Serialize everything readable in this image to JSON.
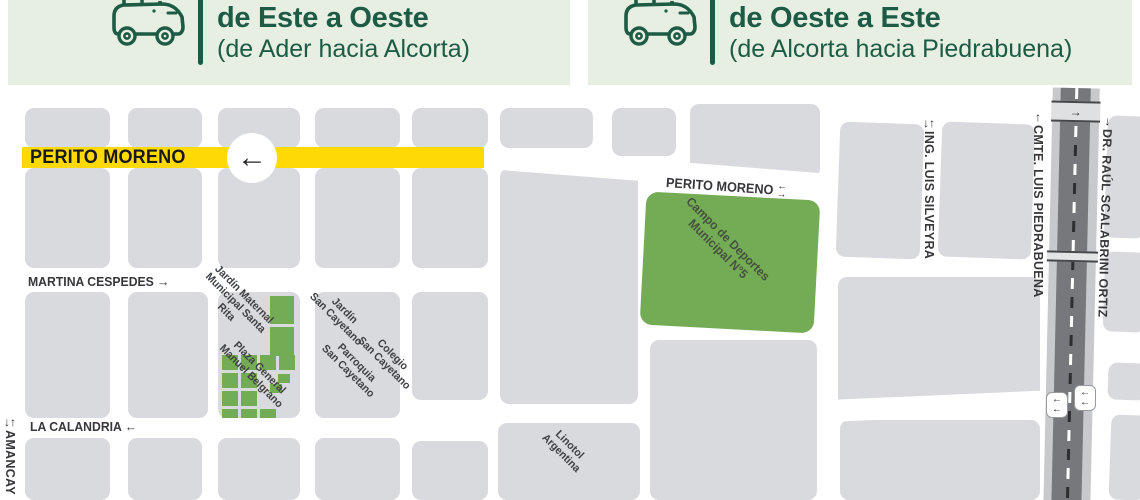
{
  "header": {
    "left": {
      "title": "de Este a Oeste",
      "subtitle": "(de Ader hacia Alcorta)"
    },
    "right": {
      "title": "de Oeste a Este",
      "subtitle": "(de Alcorta hacia Piedrabuena)"
    }
  },
  "colors": {
    "header_green": "#1d5b44",
    "header_bg": "#e6efe2",
    "route_yellow": "#ffd903",
    "park_green": "#74ac55",
    "block_gray": "#d8dade",
    "road_gray": "#77787b"
  },
  "map": {
    "route": {
      "name": "PERITO MORENO",
      "arrow": "←"
    },
    "streets": {
      "perito_moreno_east": {
        "name": "PERITO MORENO",
        "arrow_up": "←",
        "arrow_down": "→"
      },
      "martina_cespedes": {
        "name": "MARTINA CESPEDES",
        "arrow": "→"
      },
      "la_calandria": {
        "name": "LA CALANDRIA",
        "arrow": "←"
      },
      "amancay": {
        "name": "AMANCAY",
        "arrow_down": "↓",
        "arrow_up": "↑"
      },
      "ing_luis_silveyra": {
        "name": "ING. LUIS SILVEYRA",
        "arrow_down": "↓",
        "arrow_up": "↑"
      },
      "cmte_luis_piedrabuena": {
        "name": "CMTE. LUIS PIEDRABUENA",
        "arrow": "↑"
      },
      "dr_raul_scalabrini_ortiz": {
        "name": "DR. RAÚL SCALABRINI ORTIZ",
        "arrow": "↓"
      },
      "road_top_arrow": "→",
      "badge_arrow": "←"
    },
    "places": {
      "jardin_maternal": [
        "Jardín Maternal",
        "Municipal Santa",
        "Rita"
      ],
      "plaza_belgrano": [
        "Plaza General",
        "Manuel Belgrano"
      ],
      "jardin_san_cayetano": [
        "Jardín",
        "San Cayetano"
      ],
      "parroquia_san_cayetano": [
        "Parroquia",
        "San Cayetano"
      ],
      "colegio_san_cayetano": [
        "Colegio",
        "San Cayetano"
      ],
      "campo_deportes": [
        "Campo de Deportes",
        "Municipal N°5"
      ],
      "linotol": [
        "Linotol",
        "Argentina"
      ]
    }
  }
}
